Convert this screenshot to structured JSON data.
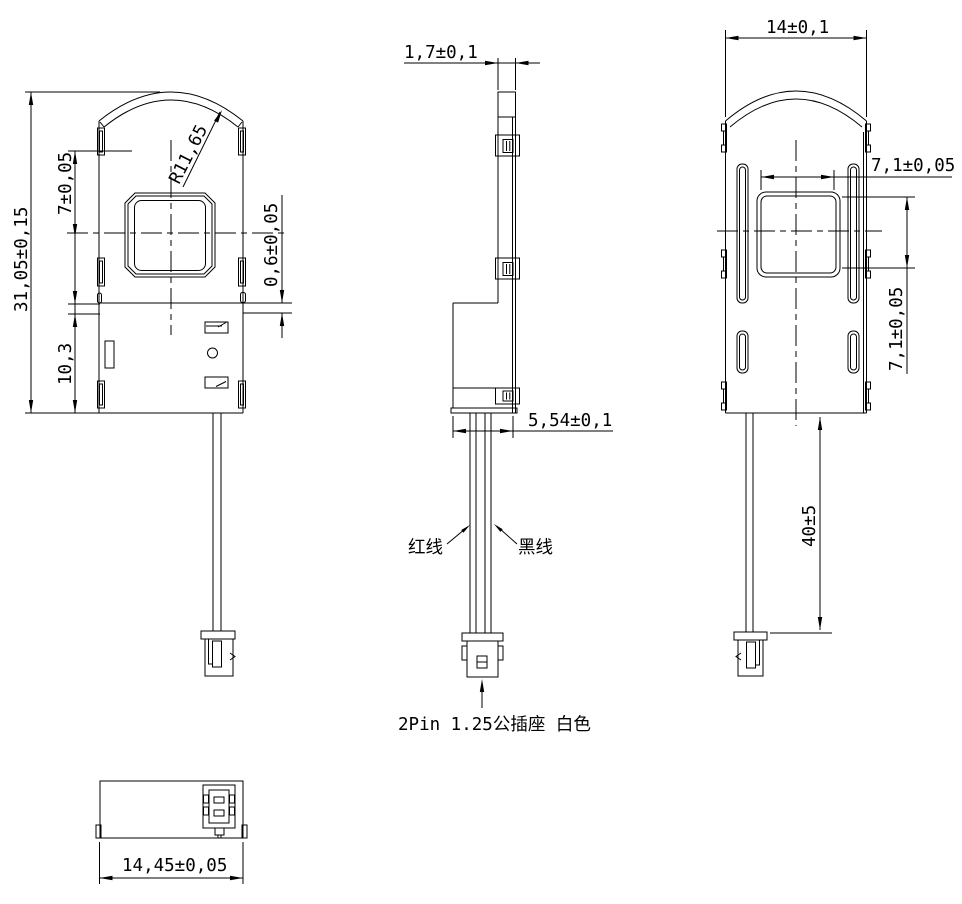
{
  "views": {
    "front": {
      "dims": {
        "overall_height": "31,05±0,15",
        "window_center_offset": "7±0,05",
        "lower_section_height": "10,3",
        "lip_step": "0,6±0,05",
        "top_radius": "R11,65"
      }
    },
    "side": {
      "dims": {
        "shell_thickness": "1,7±0,1",
        "base_depth": "5,54±0,1"
      },
      "labels": {
        "red_wire": "红线",
        "black_wire": "黑线",
        "connector": "2Pin 1.25公插座 白色"
      }
    },
    "rear": {
      "dims": {
        "overall_width": "14±0,1",
        "window_width": "7,1±0,05",
        "window_height": "7,1±0,05",
        "wire_length": "40±5"
      }
    },
    "bottom": {
      "dims": {
        "overall_width": "14,45±0,05"
      }
    }
  },
  "colors": {
    "line": "#000000",
    "background": "#ffffff"
  }
}
